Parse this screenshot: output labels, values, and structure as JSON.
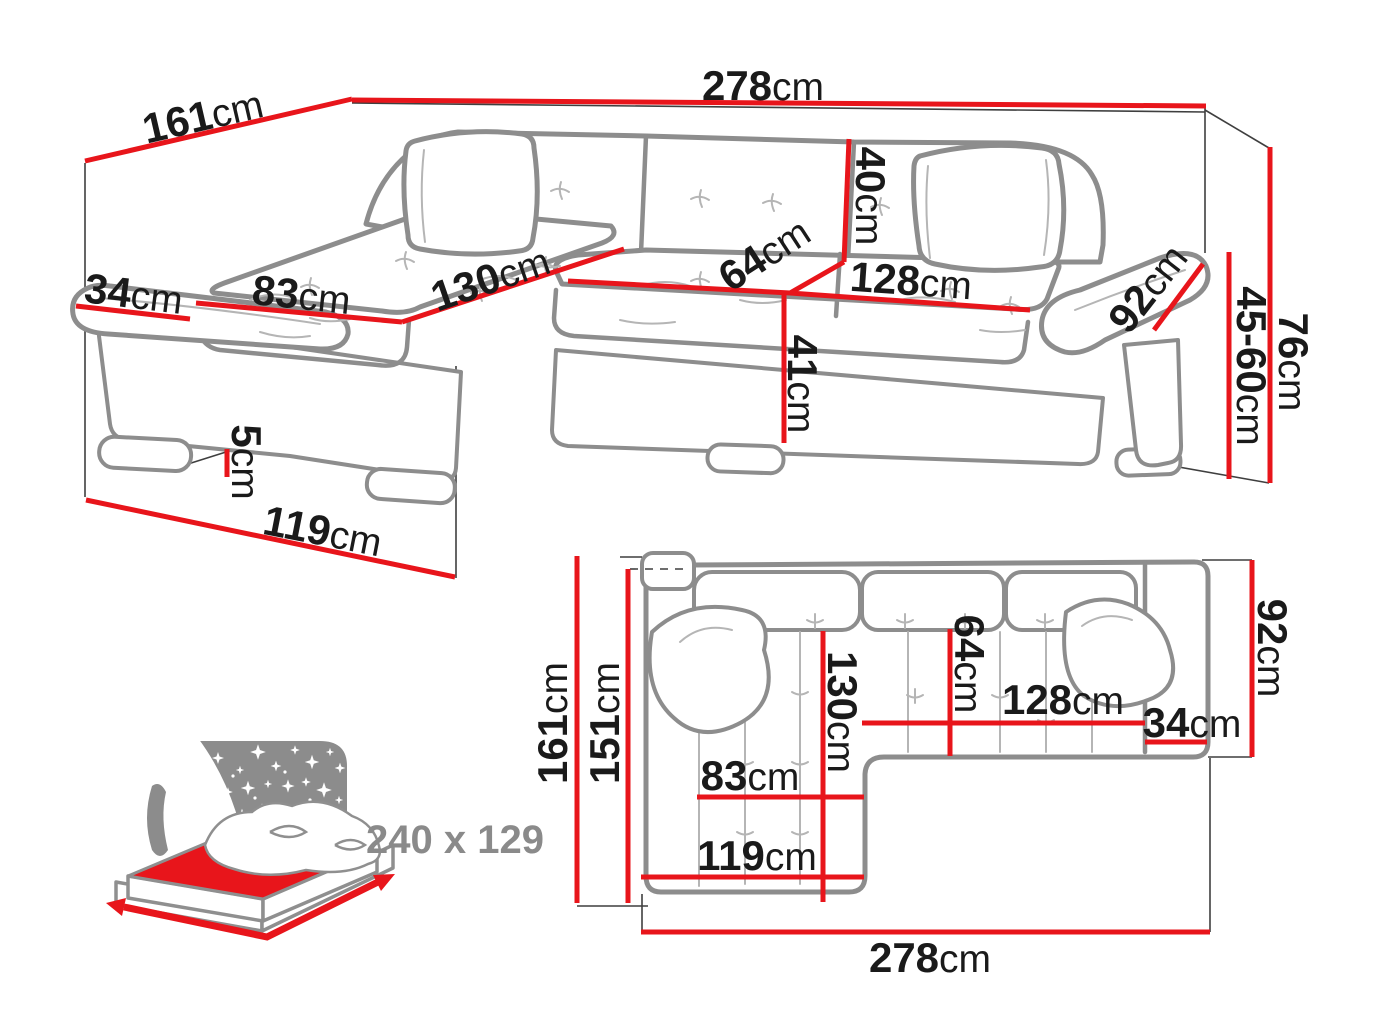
{
  "figure": {
    "kind": "corner-sofa dimension diagram",
    "colors": {
      "dimension_red": "#e8151b",
      "sofa_gray": "#8d8d8d",
      "text_dark": "#1a1a1a",
      "muted_gray": "#8a8a8a"
    }
  },
  "perspective": {
    "total_width": {
      "v": "278",
      "u": "cm"
    },
    "total_depth": {
      "v": "161",
      "u": "cm"
    },
    "arm_width": {
      "v": "34",
      "u": "cm"
    },
    "chaise_seat_width": {
      "v": "83",
      "u": "cm"
    },
    "chaise_length": {
      "v": "130",
      "u": "cm"
    },
    "backrest_height": {
      "v": "40",
      "u": "cm"
    },
    "seat_depth": {
      "v": "64",
      "u": "cm"
    },
    "seat_width": {
      "v": "128",
      "u": "cm"
    },
    "arm_length": {
      "v": "92",
      "u": "cm"
    },
    "seat_height": {
      "v": "41",
      "u": "cm"
    },
    "leg_height": {
      "v": "5",
      "u": "cm"
    },
    "chaise_front_width": {
      "v": "119",
      "u": "cm"
    },
    "total_height": {
      "v": "76",
      "u": "cm"
    },
    "armrest_height": {
      "v": "45-60",
      "u": "cm"
    }
  },
  "plan": {
    "chaise_total_depth": {
      "v": "161",
      "u": "cm"
    },
    "chaise_inner_depth": {
      "v": "151",
      "u": "cm"
    },
    "chaise_length": {
      "v": "130",
      "u": "cm"
    },
    "seat_depth": {
      "v": "64",
      "u": "cm"
    },
    "seat_width": {
      "v": "128",
      "u": "cm"
    },
    "arm_width": {
      "v": "34",
      "u": "cm"
    },
    "body_depth": {
      "v": "92",
      "u": "cm"
    },
    "chaise_seat_width": {
      "v": "83",
      "u": "cm"
    },
    "chaise_front_width": {
      "v": "119",
      "u": "cm"
    },
    "total_width": {
      "v": "278",
      "u": "cm"
    }
  },
  "sleeping": {
    "size_label": "240 x 129"
  }
}
